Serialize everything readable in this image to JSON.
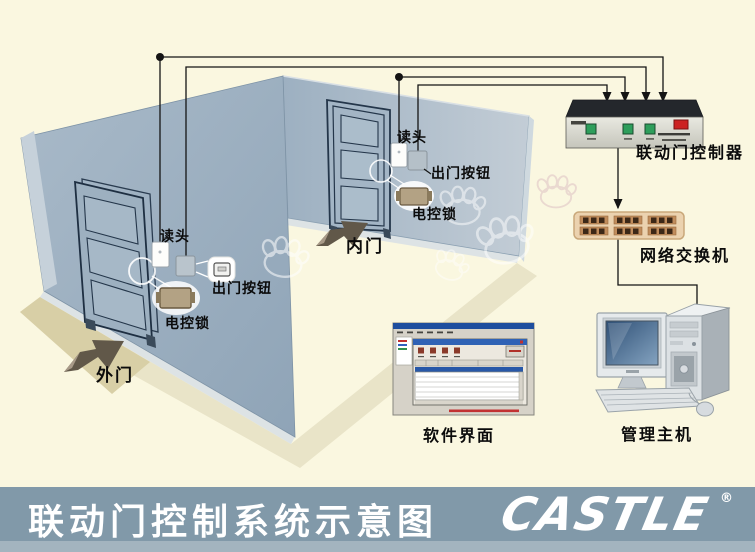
{
  "footer": {
    "title": "联动门控制系统示意图",
    "logo": "CASTLE",
    "registered": "®",
    "bar_color": "#8199a9"
  },
  "outer_door": {
    "name": "外门",
    "reader": "读头",
    "exit_button": "出门按钮",
    "lock": "电控锁"
  },
  "inner_door": {
    "name": "内门",
    "reader": "读头",
    "exit_button": "出门按钮",
    "lock": "电控锁"
  },
  "devices": {
    "controller": "联动门控制器",
    "network_switch": "网络交换机",
    "software_ui": "软件界面",
    "host": "管理主机"
  },
  "colors": {
    "background": "#faf7e0",
    "wall": "#9fb2c3",
    "controller_button": "#2e9e5b",
    "controller_switch": "#cc2222",
    "network_switch_body": "#ebd2af",
    "wire": "#141414",
    "footer_bar": "#8199a9"
  }
}
